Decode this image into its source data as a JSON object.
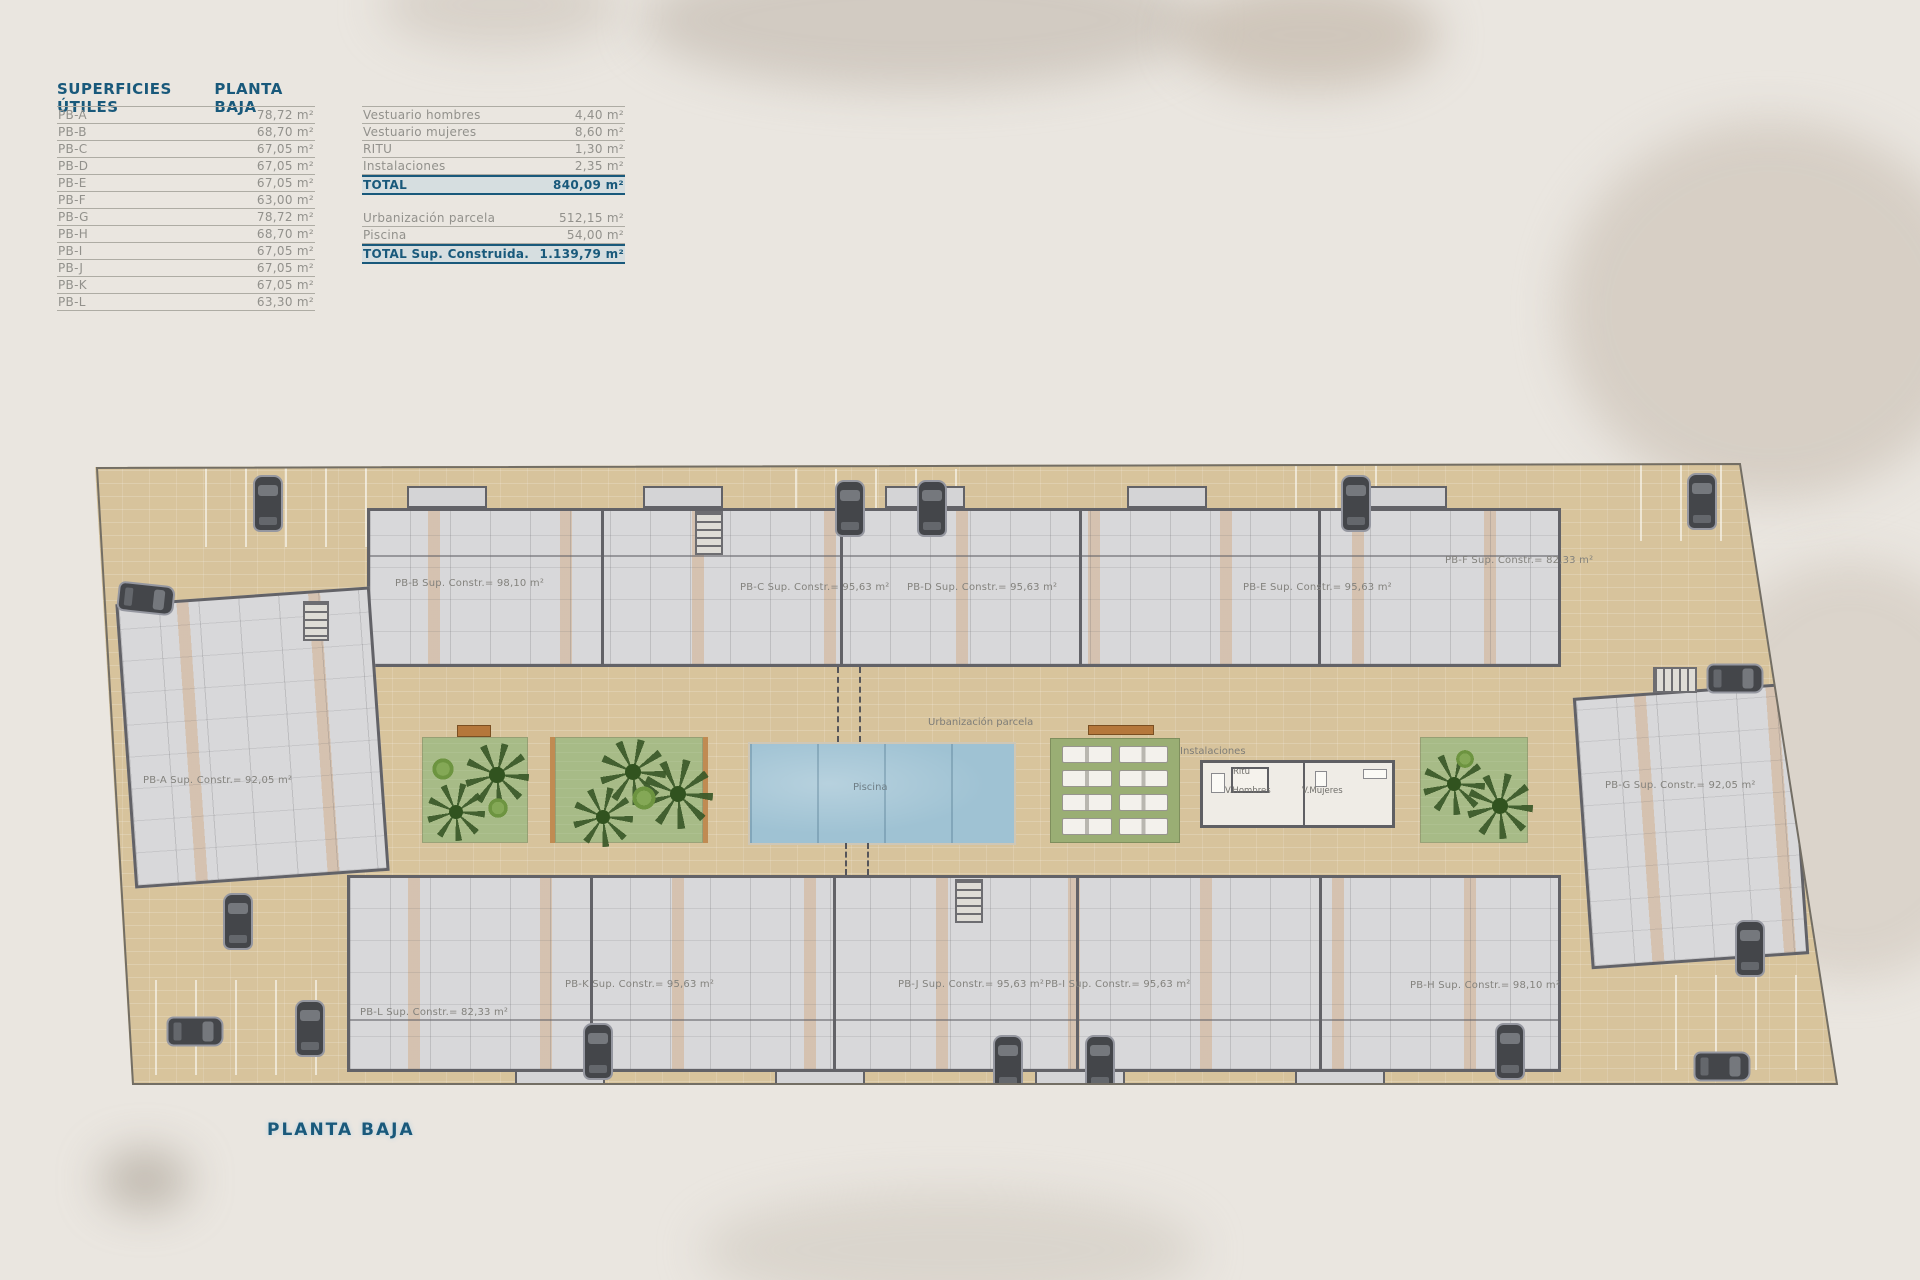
{
  "header": {
    "title": "SUPERFICIES ÚTILES",
    "subtitle": "PLANTA BAJA"
  },
  "footer": {
    "label": "PLANTA BAJA"
  },
  "surfaces": {
    "rows": [
      {
        "label": "PB-A",
        "value": "78,72 m²"
      },
      {
        "label": "PB-B",
        "value": "68,70 m²"
      },
      {
        "label": "PB-C",
        "value": "67,05 m²"
      },
      {
        "label": "PB-D",
        "value": "67,05 m²"
      },
      {
        "label": "PB-E",
        "value": "67,05 m²"
      },
      {
        "label": "PB-F",
        "value": "63,00 m²"
      },
      {
        "label": "PB-G",
        "value": "78,72 m²"
      },
      {
        "label": "PB-H",
        "value": "68,70 m²"
      },
      {
        "label": "PB-I",
        "value": "67,05 m²"
      },
      {
        "label": "PB-J",
        "value": "67,05 m²"
      },
      {
        "label": "PB-K",
        "value": "67,05 m²"
      },
      {
        "label": "PB-L",
        "value": "63,30 m²"
      }
    ]
  },
  "summary": {
    "rows": [
      {
        "label": "Vestuario hombres",
        "value": "4,40 m²"
      },
      {
        "label": "Vestuario mujeres",
        "value": "8,60 m²"
      },
      {
        "label": "RITU",
        "value": "1,30 m²"
      },
      {
        "label": "Instalaciones",
        "value": "2,35 m²"
      }
    ],
    "total": {
      "label": "TOTAL",
      "value": "840,09 m²"
    },
    "rows2": [
      {
        "label": "Urbanización parcela",
        "value": "512,15 m²"
      },
      {
        "label": "Piscina",
        "value": "54,00 m²"
      }
    ],
    "total2": {
      "label": "TOTAL Sup. Construida.",
      "value": "1.139,79 m²"
    }
  },
  "plan": {
    "units": [
      {
        "id": "PB-A",
        "label": "PB-A Sup. Constr.= 92,05 m²"
      },
      {
        "id": "PB-B",
        "label": "PB-B Sup. Constr.= 98,10 m²"
      },
      {
        "id": "PB-C",
        "label": "PB-C Sup. Constr.= 95,63 m²"
      },
      {
        "id": "PB-D",
        "label": "PB-D Sup. Constr.= 95,63 m²"
      },
      {
        "id": "PB-E",
        "label": "PB-E Sup. Constr.= 95,63 m²"
      },
      {
        "id": "PB-F",
        "label": "PB-F Sup. Constr.= 82,33 m²"
      },
      {
        "id": "PB-G",
        "label": "PB-G Sup. Constr.= 92,05 m²"
      },
      {
        "id": "PB-H",
        "label": "PB-H Sup. Constr.= 98,10 m²"
      },
      {
        "id": "PB-I",
        "label": "PB-I Sup. Constr.= 95,63 m²"
      },
      {
        "id": "PB-J",
        "label": "PB-J Sup. Constr.= 95,63 m²"
      },
      {
        "id": "PB-K",
        "label": "PB-K Sup. Constr.= 95,63 m²"
      },
      {
        "id": "PB-L",
        "label": "PB-L Sup. Constr.= 82,33 m²"
      }
    ],
    "labels": {
      "urbanizacion": "Urbanización parcela",
      "piscina": "Piscina",
      "instalaciones": "Instalaciones",
      "ritu": "Ritu",
      "v_hombres": "V.Hombres",
      "v_mujeres": "V.Mujeres"
    }
  },
  "colors": {
    "accent_blue": "#19597b",
    "ground_tan": "#dbc8a1",
    "pool_blue": "#9fc2d3",
    "garden_green": "#a7bb87",
    "text_gray": "#92918c"
  }
}
